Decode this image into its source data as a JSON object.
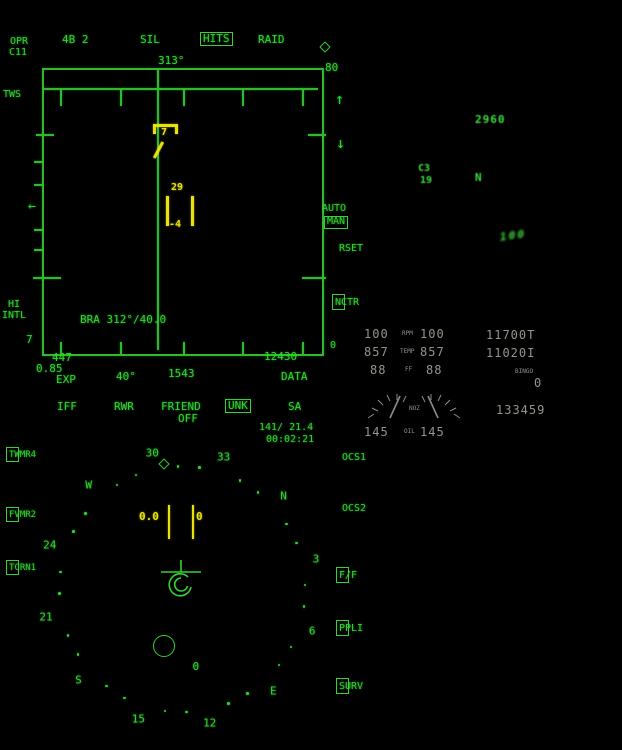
{
  "colors": {
    "mfd_green": "#31d431",
    "target_yellow": "#e8e20a",
    "ifei_gray": "#96948b",
    "hud_green": "#3fe03f",
    "background": "#000000"
  },
  "icons": {
    "up_arrow": "↑",
    "down_arrow": "↓",
    "left_caret_arrow": "←",
    "course_diamond": "◇"
  },
  "radar": {
    "mode": "OPR",
    "channel": "C11",
    "menu": {
      "bars": "4B 2",
      "sil": "SIL",
      "hits": "HITS",
      "raid": "RAID"
    },
    "heading_top": "313°",
    "range_max": "80",
    "range_min": "0",
    "scan_mode": "TWS",
    "auto_label": "AUTO",
    "man_label": "MAN",
    "rset_label": "RSET",
    "nctr_label": "NCTR",
    "bra_readout": "BRA 312°/40.0",
    "hi_label": "HI",
    "intl_label": "INTL",
    "own_alt": "7",
    "bottom": {
      "left_num": "447",
      "mach": "0.85",
      "exp": "EXP",
      "azimuth": "40°",
      "time": "1543",
      "right_num": "12430",
      "data": "DATA"
    },
    "contacts": {
      "bandit_number": "7",
      "ls_altitude": "29",
      "ls_aspect": "-4"
    }
  },
  "hsi": {
    "header": {
      "iff": "IFF",
      "rwr": "RWR",
      "friend": "FRIEND",
      "off": "OFF",
      "unk": "UNK",
      "sa": "SA",
      "course_speed": "141/ 21.4",
      "time": "00:02:21"
    },
    "left_buttons": [
      {
        "label": "TWMR4"
      },
      {
        "label": "FVMR2"
      },
      {
        "label": "TCRN1"
      }
    ],
    "right_buttons": [
      {
        "label": "OCS1",
        "boxed": false
      },
      {
        "label": "OCS2",
        "boxed": false
      },
      {
        "label": "F/F",
        "boxed": true
      },
      {
        "label": "PPLI",
        "boxed": true
      },
      {
        "label": "SURV",
        "boxed": true
      }
    ],
    "compass": {
      "heading": 312,
      "diamond_bearing": 304,
      "labels": [
        {
          "text": "N",
          "bearing": 0
        },
        {
          "text": "3",
          "bearing": 30
        },
        {
          "text": "6",
          "bearing": 60
        },
        {
          "text": "E",
          "bearing": 90
        },
        {
          "text": "12",
          "bearing": 120
        },
        {
          "text": "15",
          "bearing": 150
        },
        {
          "text": "S",
          "bearing": 180
        },
        {
          "text": "21",
          "bearing": 210
        },
        {
          "text": "24",
          "bearing": 240
        },
        {
          "text": "W",
          "bearing": 270
        },
        {
          "text": "30",
          "bearing": 300
        },
        {
          "text": "33",
          "bearing": 330
        }
      ]
    },
    "center": {
      "speed": "0.0",
      "right_value": "0",
      "waypoint": "0"
    }
  },
  "ifei": {
    "rpm_label": "RPM",
    "rpm_left": "100",
    "rpm_right": "100",
    "temp_label": "TEMP",
    "temp_left": "857",
    "temp_right": "857",
    "ff_label": "FF",
    "ff_left": "88",
    "ff_right": "88",
    "noz_label": "NOZ",
    "oil_label": "OIL",
    "oil_left": "145",
    "oil_right": "145"
  },
  "fuel": {
    "total": "11700T",
    "internal": "11020I",
    "bingo_label": "BINGO",
    "bingo_value": "0",
    "clock": "133459"
  },
  "hud": {
    "alt": "2960",
    "left_upper": "C3",
    "left_lower": "19",
    "heading_letter": "N",
    "lower_right": "100"
  }
}
